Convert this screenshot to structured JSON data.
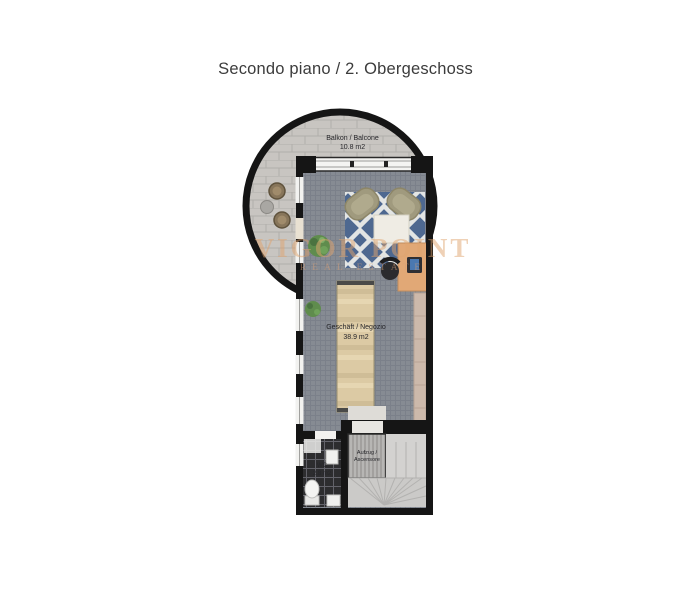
{
  "page": {
    "title": "Secondo piano / 2. Obergeschoss"
  },
  "floorplan": {
    "balcony": {
      "name": "Balkon / Balcone",
      "area": "10.8 m2"
    },
    "shop": {
      "name": "Geschäft / Negozio",
      "area": "38.9 m2"
    },
    "wc": {
      "name": "WC",
      "area": "2.8 m2"
    },
    "elevator": {
      "name_line1": "Aufzug /",
      "name_line2": "Ascensore"
    }
  },
  "watermark": {
    "line1": "VIGOR POINT",
    "line2": "REAL ESTATE"
  },
  "colors": {
    "wall": "#151515",
    "carpet": "#868b93",
    "rug_blue": "#4e6890",
    "rug_lattice": "#e3e5e4",
    "balcony_pavers": "#c8c5c1",
    "counter_wood": "#dccaa4",
    "desk_wood": "#e1a876",
    "plant_green": "#5f8c4d",
    "stairs_gray": "#cbcac8",
    "elevator_gray": "#b7b6b4",
    "wc_floor": "#2d2d2f",
    "watermark_tan": "#e0a46e"
  }
}
